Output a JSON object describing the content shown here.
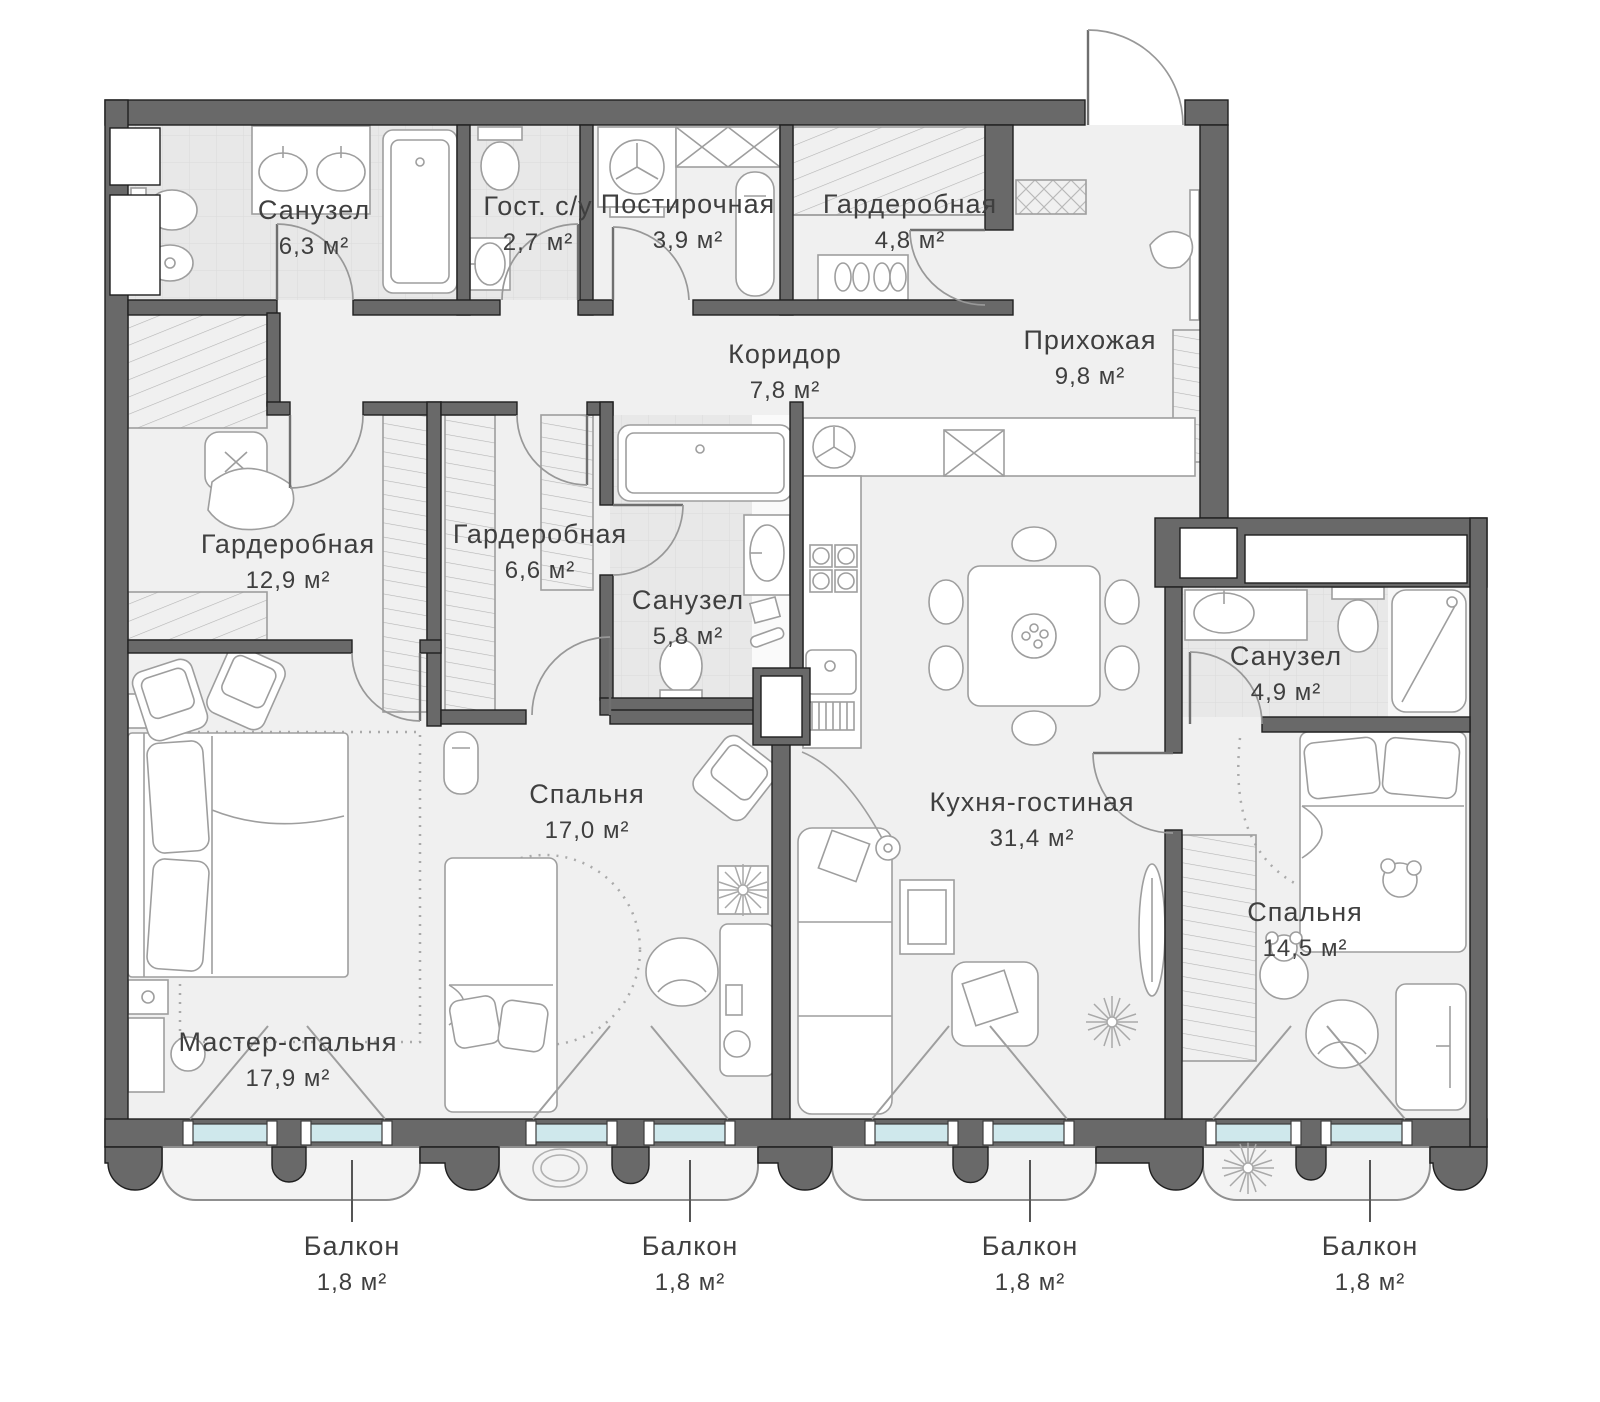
{
  "title": "Floor plan of 4-room apartment",
  "units_note": "areas in square meters",
  "palette": {
    "wall": "#696969",
    "wall_outline": "#1f1f1f",
    "floor": "#f0f0f0",
    "tile": "#e8e8e8",
    "window_glass": "#cfe8ec",
    "furniture_line": "#9e9e9e",
    "label_text": "#3f3f3f"
  },
  "rooms": [
    {
      "name": "Санузел",
      "area": "6,3 м²"
    },
    {
      "name": "Гост. с/у",
      "area": "2,7 м²"
    },
    {
      "name": "Постирочная",
      "area": "3,9 м²"
    },
    {
      "name": "Гардеробная",
      "area": "4,8 м²"
    },
    {
      "name": "Прихожая",
      "area": "9,8 м²"
    },
    {
      "name": "Коридор",
      "area": "7,8 м²"
    },
    {
      "name": "Гардеробная",
      "area": "12,9 м²"
    },
    {
      "name": "Гардеробная",
      "area": "6,6 м²"
    },
    {
      "name": "Санузел",
      "area": "5,8 м²"
    },
    {
      "name": "Санузел",
      "area": "4,9 м²"
    },
    {
      "name": "Спальня",
      "area": "17,0 м²"
    },
    {
      "name": "Кухня-гостиная",
      "area": "31,4 м²"
    },
    {
      "name": "Мастер-спальня",
      "area": "17,9 м²"
    },
    {
      "name": "Спальня",
      "area": "14,5 м²"
    }
  ],
  "balconies": [
    {
      "name": "Балкон",
      "area": "1,8 м²"
    },
    {
      "name": "Балкон",
      "area": "1,8 м²"
    },
    {
      "name": "Балкон",
      "area": "1,8 м²"
    },
    {
      "name": "Балкон",
      "area": "1,8 м²"
    }
  ]
}
